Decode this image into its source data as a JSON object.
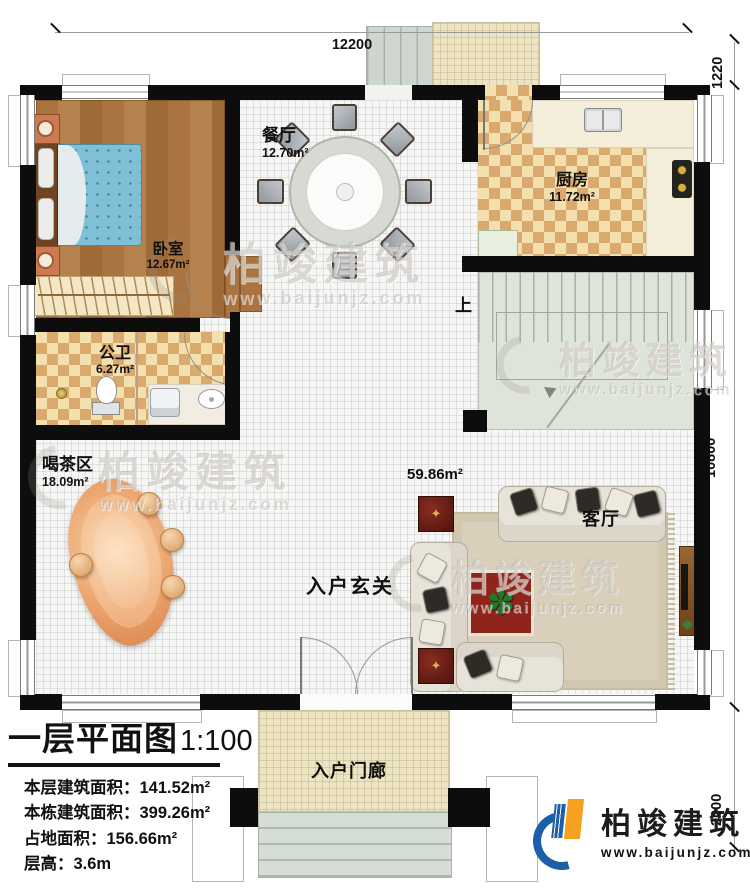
{
  "dimensions": {
    "top": "12200",
    "right_top": "1220",
    "right_middle": "10800",
    "right_bottom": "2000"
  },
  "rooms": {
    "dining": {
      "name": "餐厅",
      "area": "12.70m²"
    },
    "bedroom": {
      "name": "卧室",
      "area": "12.67m²"
    },
    "kitchen": {
      "name": "厨房",
      "area": "11.72m²"
    },
    "bathroom": {
      "name": "公卫",
      "area": "6.27m²"
    },
    "tea_area": {
      "name": "喝茶区",
      "area": "18.09m²"
    },
    "living": {
      "name": "客厅",
      "area": "59.86m²"
    },
    "foyer": {
      "name": "入户玄关"
    },
    "entry_porch": {
      "name": "入户门廊"
    }
  },
  "stairs": {
    "up_label": "上"
  },
  "title_block": {
    "title": "一层平面图",
    "scale": "1:100",
    "rows": [
      {
        "label": "本层建筑面积：",
        "value": "141.52m²"
      },
      {
        "label": "本栋建筑面积：",
        "value": "399.26m²"
      },
      {
        "label": "占地面积：",
        "value": "156.66m²"
      },
      {
        "label": "层高：",
        "value": "3.6m"
      }
    ]
  },
  "watermark": {
    "brand": "柏竣建筑",
    "url": "www.baijunjz.com"
  },
  "logo": {
    "brand": "柏竣建筑",
    "url": "www.baijunjz.com"
  },
  "icons": {
    "plant": "✽",
    "compass": "✦"
  },
  "colors": {
    "wall": "#0d0d0d",
    "accent_blue": "#1c5fa8",
    "accent_orange": "#f5a01e",
    "wood": "#a8763f",
    "checker": "#d9a96e",
    "stair": "#dfe4da"
  }
}
